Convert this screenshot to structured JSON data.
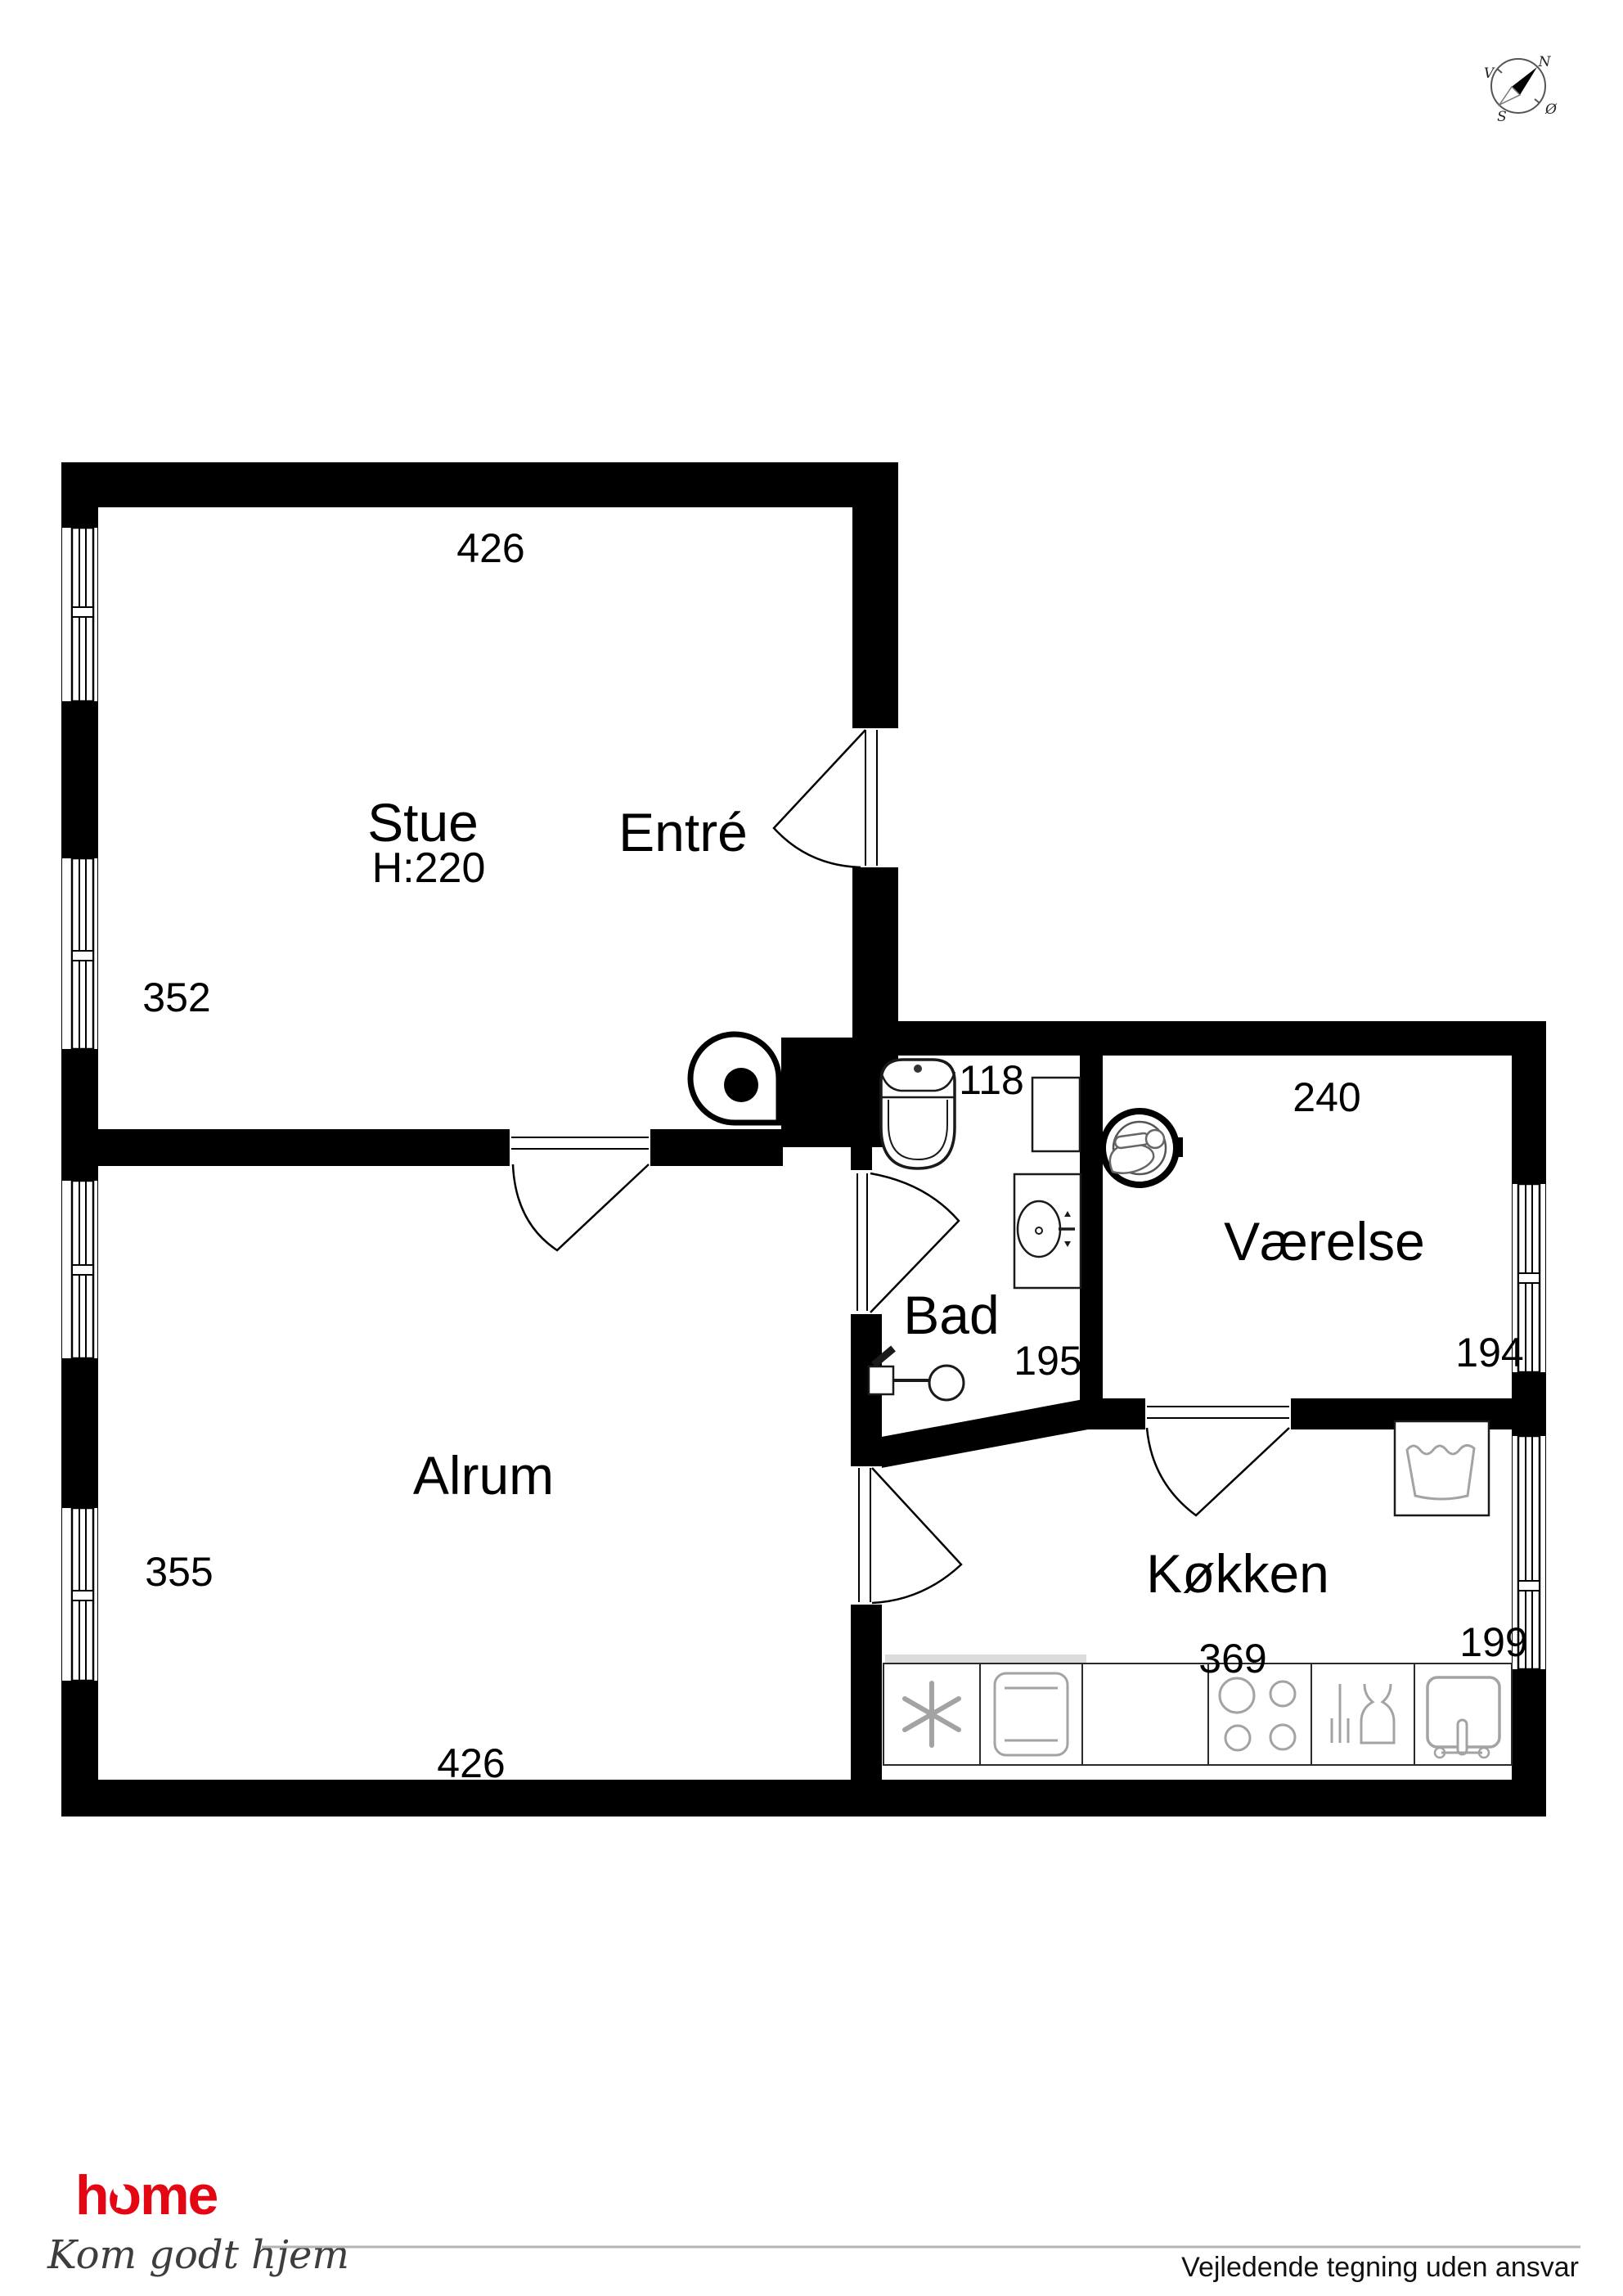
{
  "document_type": "floor-plan",
  "colors": {
    "wall": "#000000",
    "fixture_stroke": "#1a1a1a",
    "appliance_gray": "#a3a3a3",
    "rule_gray": "#b5b5b5",
    "logo_red": "#e30613"
  },
  "rooms": [
    {
      "name": "Stue",
      "ceiling_height": "H:220",
      "width_cm": "426",
      "depth_cm": "352"
    },
    {
      "name": "Entré"
    },
    {
      "name": "Bad",
      "width_cm": "118",
      "depth_cm": "195"
    },
    {
      "name": "Værelse",
      "width_cm": "240",
      "depth_cm": "194"
    },
    {
      "name": "Alrum",
      "width_cm": "426",
      "depth_cm": "355"
    },
    {
      "name": "Køkken",
      "width_cm": "369",
      "depth_cm": "199"
    }
  ],
  "compass": {
    "north": "N",
    "west": "V",
    "south": "S",
    "east": "Ø"
  },
  "icons": {
    "compass": "compass-rose-icon",
    "stove": "wood-stove-icon",
    "toilet": "toilet-icon",
    "bad_sink": "washbasin-icon",
    "shower": "shower-icon",
    "round_fixture": "round-washbasin-icon",
    "cabinet": "cabinet-icon",
    "washing_machine": "washing-machine-icon",
    "fridge": "snowflake-fridge-icon",
    "oven": "oven-icon",
    "hob": "hob-icon",
    "dishwasher": "dishwasher-icon",
    "kitchen_sink": "kitchen-sink-icon"
  },
  "branding": {
    "logo_text": "home",
    "tagline": "Kom godt hjem"
  },
  "footer": {
    "disclaimer": "Vejledende tegning uden ansvar"
  }
}
